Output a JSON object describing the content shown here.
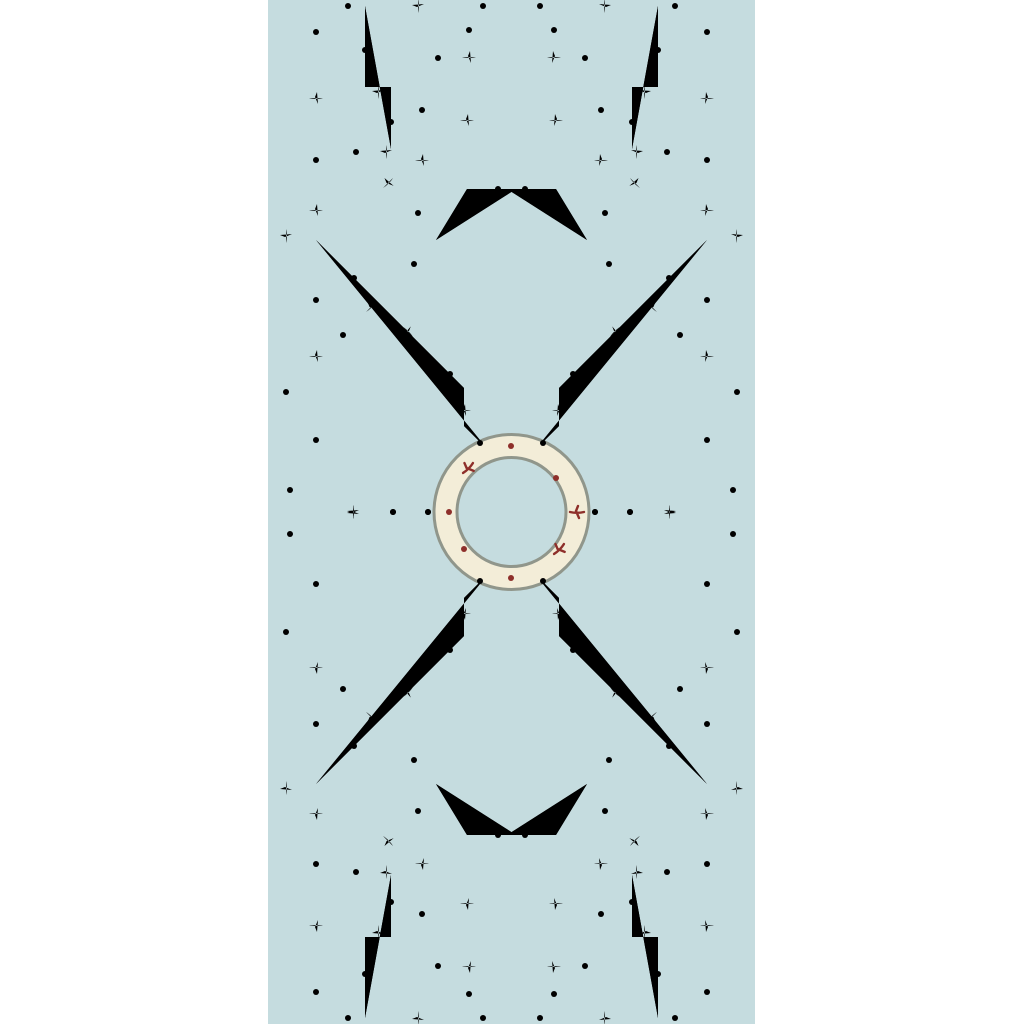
{
  "page": {
    "background_color": "#ffffff"
  },
  "swatch": {
    "description": "Chinoiserie bamboo trellis wallpaper pattern swatch on pale blue ground",
    "background_color": "#c5dcdf",
    "bamboo_fill_color": "#f3edd8",
    "bamboo_outline_color": "#90968b",
    "joint_accent_color": "#8e2f2a",
    "motifs": [
      "central bamboo ring",
      "octagonal lattice around ring",
      "diagonal X crossings",
      "greek-key staircase corners",
      "T-shaped pillar at top and bottom",
      "red bamboo joint marks and dots"
    ]
  }
}
